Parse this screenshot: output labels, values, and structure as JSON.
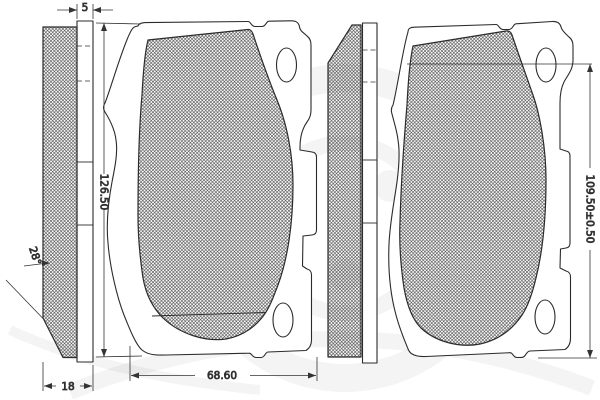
{
  "drawing": {
    "kind": "brake-pad-technical-drawing",
    "dimensions": {
      "backplate_thickness": "5",
      "total_thickness": "18",
      "chamfer_angle": "28°",
      "left_pad_height": "126.50",
      "pad_width": "68.60",
      "right_pad_height": "109.50±0.50"
    },
    "colors": {
      "line": "#2b2b2b",
      "dimension_line": "#333333",
      "background": "#ffffff"
    }
  }
}
